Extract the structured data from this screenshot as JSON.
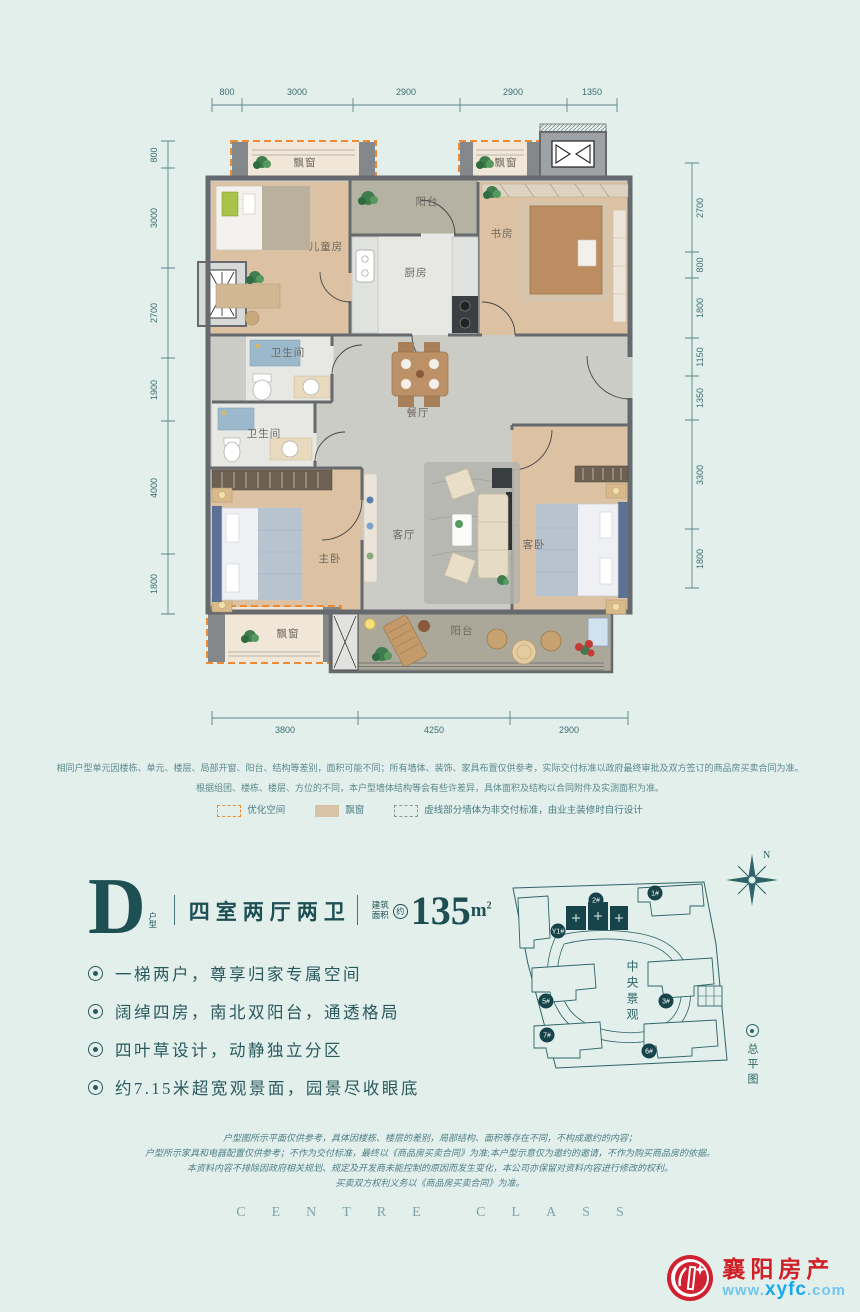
{
  "plan": {
    "dims": {
      "top": [
        "800",
        "3000",
        "2900",
        "2900",
        "1350"
      ],
      "left": [
        "800",
        "3000",
        "2700",
        "1900",
        "4000",
        "1800"
      ],
      "right": [
        "2700",
        "800",
        "1800",
        "1150",
        "1350",
        "3300",
        "1800"
      ],
      "bottom": [
        "3800",
        "4250",
        "2900"
      ]
    },
    "rooms": {
      "kids": "儿童房",
      "balcony_top": "阳台",
      "kitchen": "厨房",
      "study": "书房",
      "bath1": "卫生间",
      "bath2": "卫生间",
      "dining": "餐厅",
      "living": "客厅",
      "master": "主卧",
      "guest": "客卧",
      "balcony_bottom": "阳台",
      "bay": "飘窗"
    },
    "notes": [
      "相同户型单元因楼栋、单元、楼层、局部开窗、阳台、结构等差别，面积可能不同；所有墙体、装饰、家具布置仅供参考，实际交付标准以政府最终审批及双方签订的商品房买卖合同为准。",
      "根据组团、楼栋、楼层、方位的不同，本户型墙体结构等会有些许差异，具体面积及结构以合同附件及实测面积为准。"
    ],
    "legend": [
      {
        "label": "优化空间"
      },
      {
        "label": "飘窗"
      },
      {
        "label": "虚线部分墙体为非交付标准，由业主装修时自行设计"
      }
    ]
  },
  "unit": {
    "letter": "D",
    "letter_sub": "户型",
    "layout": "四室两厅两卫",
    "area_label_1": "建筑",
    "area_label_2": "面积",
    "area_approx": "约",
    "area_value": "135",
    "area_unit": "m",
    "area_sup": "2",
    "features": [
      "一梯两户，尊享归家专属空间",
      "阔绰四房，南北双阳台，通透格局",
      "四叶草设计，动静独立分区",
      "约7.15米超宽观景面，园景尽收眼底"
    ]
  },
  "siteplan": {
    "north": "N",
    "center_label": "中央景观",
    "caption": "总平图",
    "buildings": [
      "Y1#",
      "2#",
      "1#",
      "5#",
      "3#",
      "7#",
      "6#"
    ]
  },
  "footer": {
    "disclaimers": [
      "户型图所示平面仅供参考，具体因楼栋、楼层的差别，局部结构、面积等存在不同，不构成邀约的内容；",
      "户型所示家具和电器配置仅供参考；不作为交付标准，最终以《商品房买卖合同》为准;本户型示意仅为邀约的邀请，不作为购买商品房的依据。",
      "本资料内容不排除因政府相关规划、规定及开发商未能控制的原因而发生变化，本公司亦保留对资料内容进行修改的权利。",
      "买卖双方权利义务以《商品房买卖合同》为准。"
    ],
    "brand_en": "CENTRE CLASS",
    "logo": {
      "name": "襄阳房产",
      "site_www": "www.",
      "site_name": "xyfc",
      "site_com": ".com"
    }
  },
  "colors": {
    "background": "#e2efeb",
    "wall": "#66696d",
    "optimize_orange": "#ef8a33",
    "teal": "#2e6468",
    "logo_red": "#d22028",
    "logo_blue": "#18a8ee"
  }
}
